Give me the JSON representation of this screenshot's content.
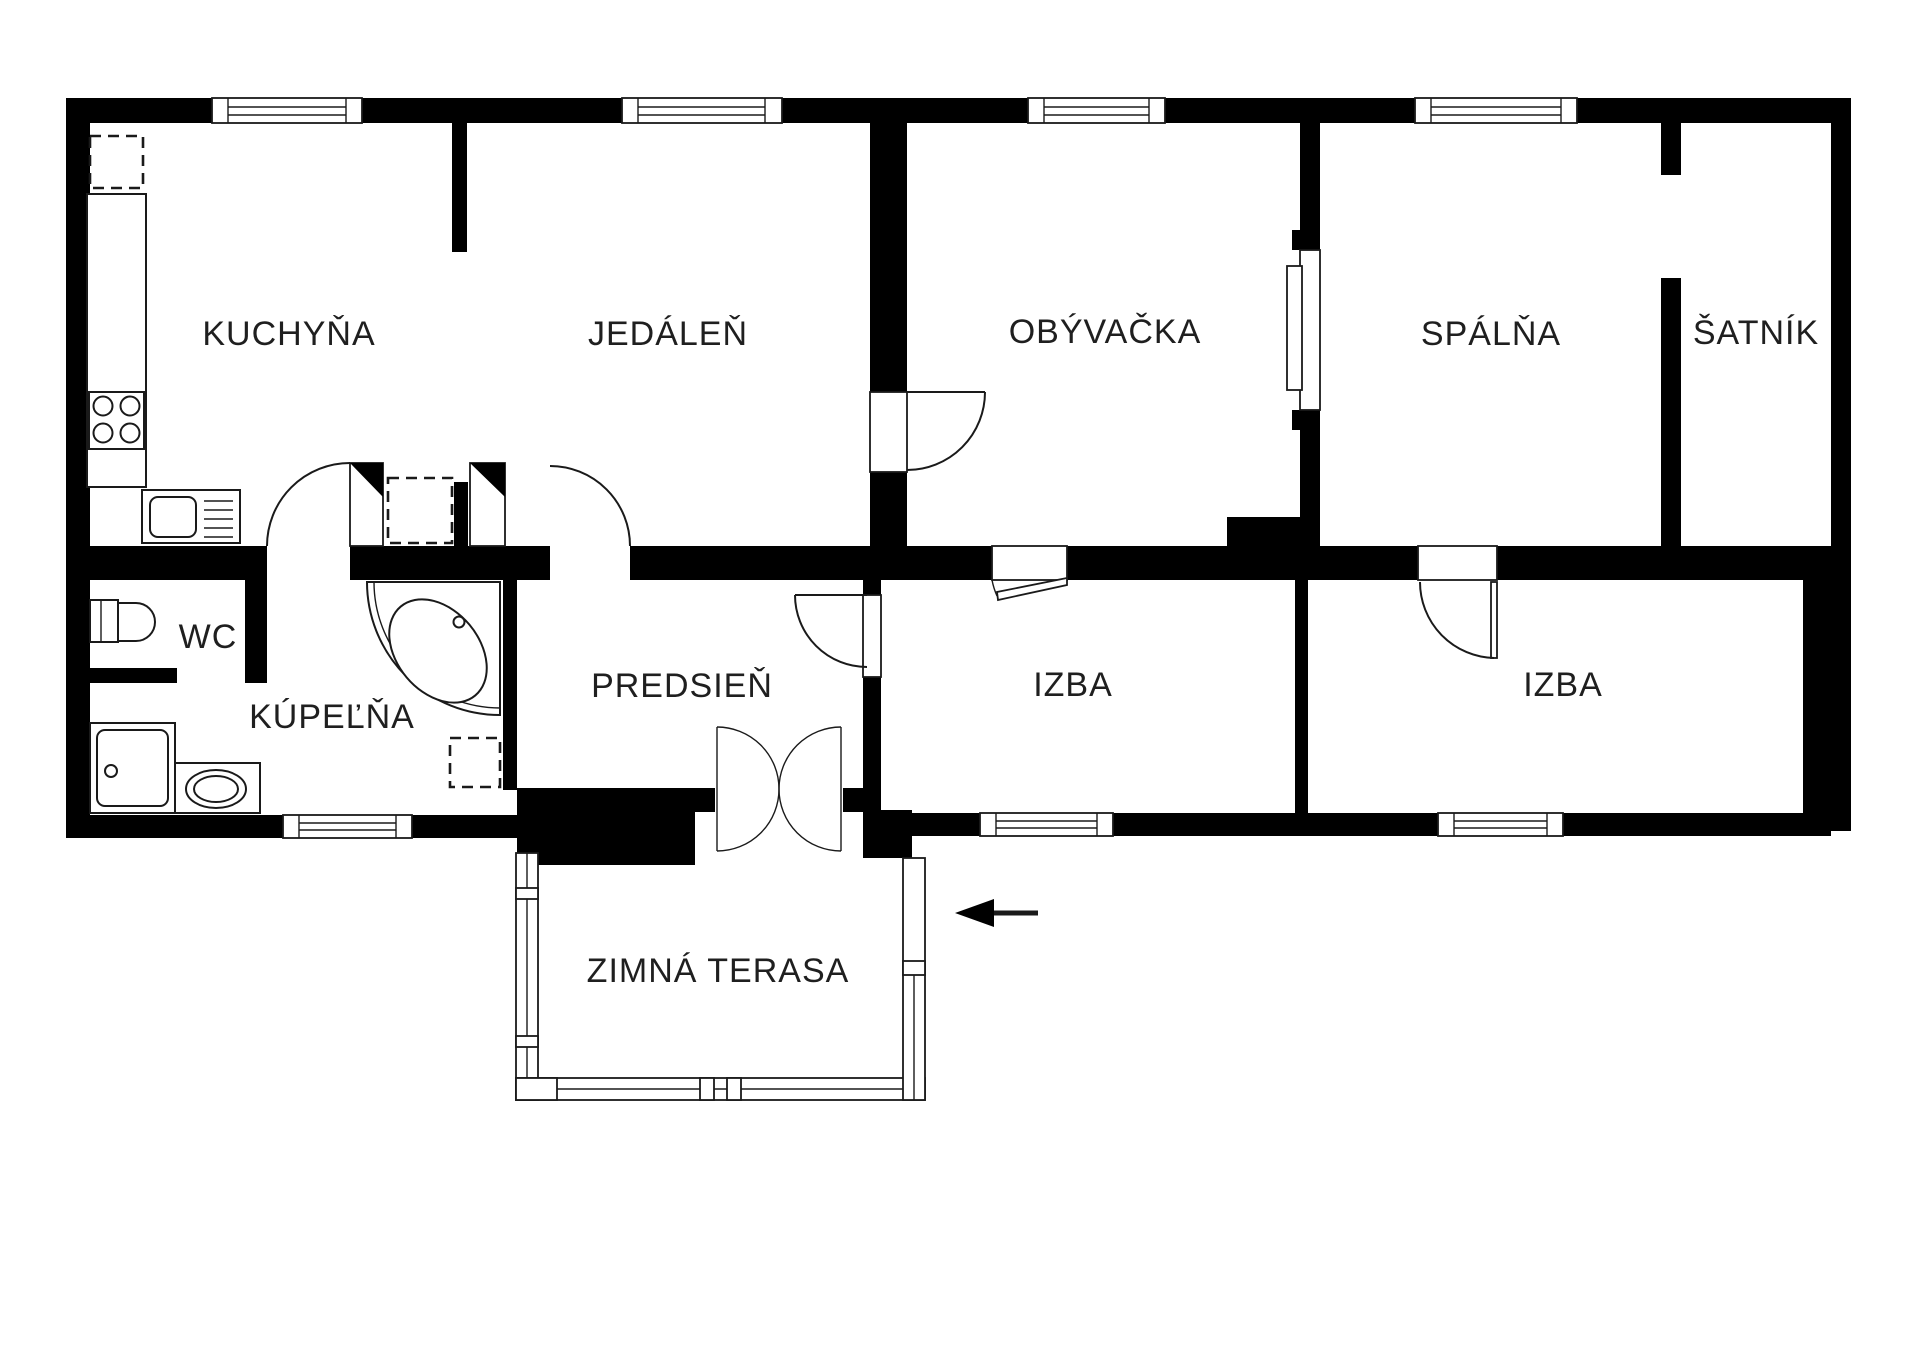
{
  "rooms": {
    "kitchen": {
      "label": "KUCHYŇA"
    },
    "dining": {
      "label": "JEDÁLEŇ"
    },
    "living": {
      "label": "OBÝVAČKA"
    },
    "bedroom": {
      "label": "SPÁLŇA"
    },
    "closet": {
      "label": "ŠATNÍK"
    },
    "wc": {
      "label": "WC"
    },
    "bathroom": {
      "label": "KÚPEĽŇA"
    },
    "hall": {
      "label": "PREDSIEŇ"
    },
    "room_left": {
      "label": "IZBA"
    },
    "room_right": {
      "label": "IZBA"
    },
    "terrace": {
      "label": "ZIMNÁ TERASA"
    }
  },
  "symbols": {
    "entrance_arrow": "arrow-left",
    "fridge": "dashed-square",
    "stove": "four-burner-cooktop",
    "sink": "kitchen-sink-with-drainer",
    "toilet": "wc-toilet",
    "shower": "shower-tray",
    "washer": "washing-machine",
    "bathtub": "corner-bathtub",
    "double_door": "double-swing-door",
    "sliding_door": "sliding-door-panel"
  },
  "colors": {
    "wall": "#000000",
    "background": "#ffffff",
    "stroke": "#1a1a1a"
  }
}
